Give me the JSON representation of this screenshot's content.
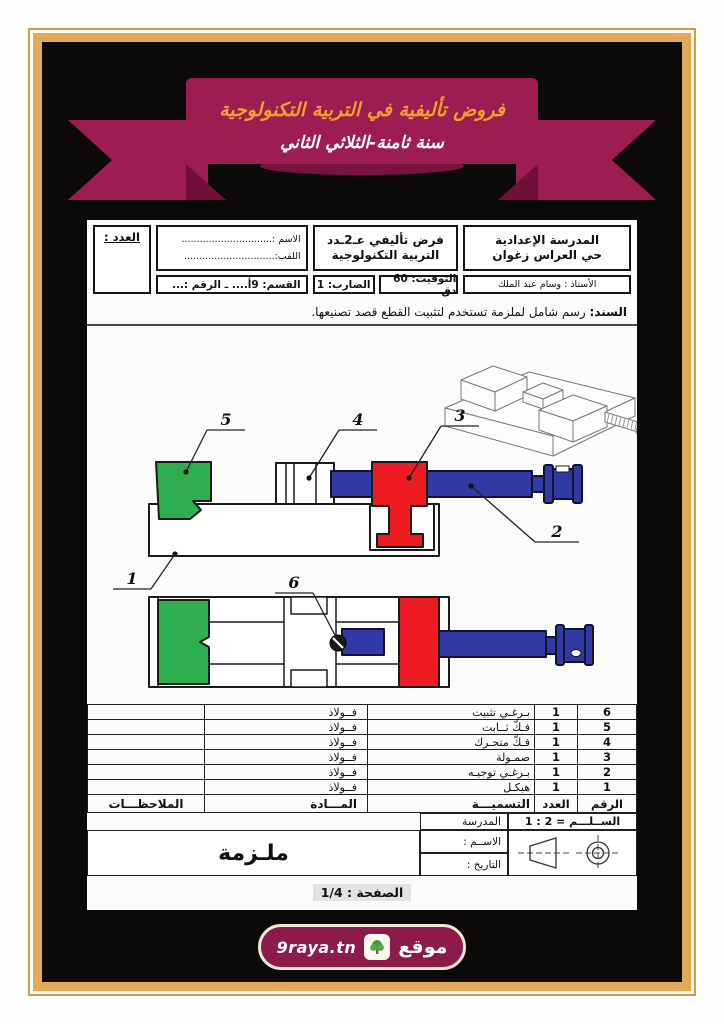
{
  "banner": {
    "line1": "فروض تأليفية في التربية التكنولوجية",
    "line2": "سنة ثامنة-الثلاثي الثاني"
  },
  "header": {
    "school_name": "المدرسة الإعدادية",
    "school_location": "حي العراس زغوان",
    "teacher": "الأستاذ : وسام عبد الملك",
    "exam_title_line1": "فرض تأليفي عـ2ـدد",
    "exam_title_line2": "التربية التكنولوجية",
    "duration": "التوقيت: 60 دق",
    "coefficient": "الضارب: 1",
    "name_label": "الاسم :..............................",
    "surname_label": "اللقب:..............................",
    "class_label": "القسم: 9أ.... ـ الرقم :...",
    "grade_label": "العدد :"
  },
  "support": {
    "label": "السند:",
    "text": " رسم شامل لملزمة تستخدم لتثبيت القطع قصد تصنيعها."
  },
  "drawing": {
    "callouts": [
      "1",
      "2",
      "3",
      "4",
      "5",
      "6"
    ]
  },
  "parts_table": {
    "headers": {
      "number": "الرقم",
      "qty": "العدد",
      "name": "التسميـــة",
      "material": "المـــادة",
      "notes": "الملاحظـــات"
    },
    "rows": [
      {
        "number": "6",
        "qty": "1",
        "name": "بـرغـي تثبيت",
        "material": "فــولاذ",
        "notes": ""
      },
      {
        "number": "5",
        "qty": "1",
        "name": "فـكّ ثــابت",
        "material": "فــولاذ",
        "notes": ""
      },
      {
        "number": "4",
        "qty": "1",
        "name": "فـكّ متحـرك",
        "material": "فــولاذ",
        "notes": ""
      },
      {
        "number": "3",
        "qty": "1",
        "name": "صمـولة",
        "material": "فــولاذ",
        "notes": ""
      },
      {
        "number": "2",
        "qty": "1",
        "name": "بـرغـي توجيـه",
        "material": "فــولاذ",
        "notes": ""
      },
      {
        "number": "1",
        "qty": "1",
        "name": "هيكـل",
        "material": "فــولاذ",
        "notes": ""
      }
    ]
  },
  "title_block": {
    "scale": "الســلـــم = 2 : 1",
    "school_row": "المدرسة",
    "name_row": "الاســم :",
    "date_row": "التاريخ :",
    "part_title": "ملـزمة"
  },
  "footer": {
    "page": "الصفحة : 1/4",
    "logo_site_word": "موقع",
    "logo_domain": "9raya.tn"
  },
  "colors": {
    "ribbon": "#9d1c51",
    "ribbon_fold": "#701038",
    "gold_text": "#f0a12c",
    "frame_gold": "#e2aa57",
    "part_green": "#2fae4f",
    "part_red": "#ee1b22",
    "part_blue": "#3039a4"
  }
}
